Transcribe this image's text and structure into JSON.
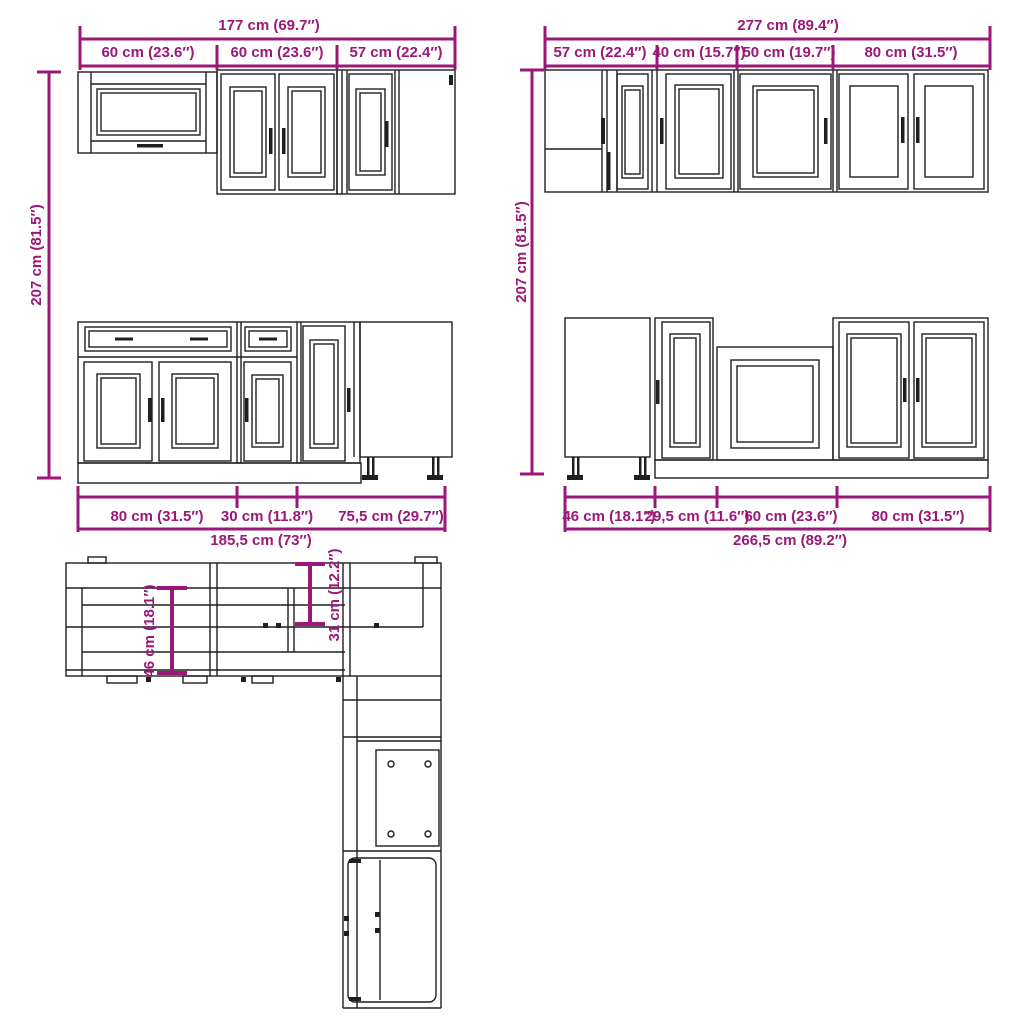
{
  "title": "Kitchen cabinet set dimension diagram",
  "colors": {
    "dimension": "#9b1778",
    "line": "#1f1f1f",
    "background": "#ffffff"
  },
  "diagram": {
    "wall_left": {
      "total": "177 cm (69.7″)",
      "segments": [
        "60 cm (23.6″)",
        "60 cm (23.6″)",
        "57 cm (22.4″)"
      ],
      "height": "207 cm (81.5″)"
    },
    "wall_right": {
      "total": "277 cm (89.4″)",
      "segments": [
        "57 cm (22.4″)",
        "40 cm (15.7″)",
        "50 cm (19.7″)",
        "80 cm (31.5″)"
      ],
      "height": "207 cm (81.5″)"
    },
    "base_left": {
      "segments": [
        "80 cm (31.5″)",
        "30 cm (11.8″)",
        "75,5 cm (29.7″)"
      ],
      "total": "185,5 cm (73″)"
    },
    "base_right": {
      "segments": [
        "46 cm (18.1″)",
        "29,5 cm (11.6″)",
        "60 cm (23.6″)",
        "80 cm (31.5″)"
      ],
      "total": "266,5 cm (89.2″)"
    },
    "plan": {
      "base_depth": "46 cm (18.1″)",
      "wall_depth": "31 cm (12.2″)"
    }
  }
}
